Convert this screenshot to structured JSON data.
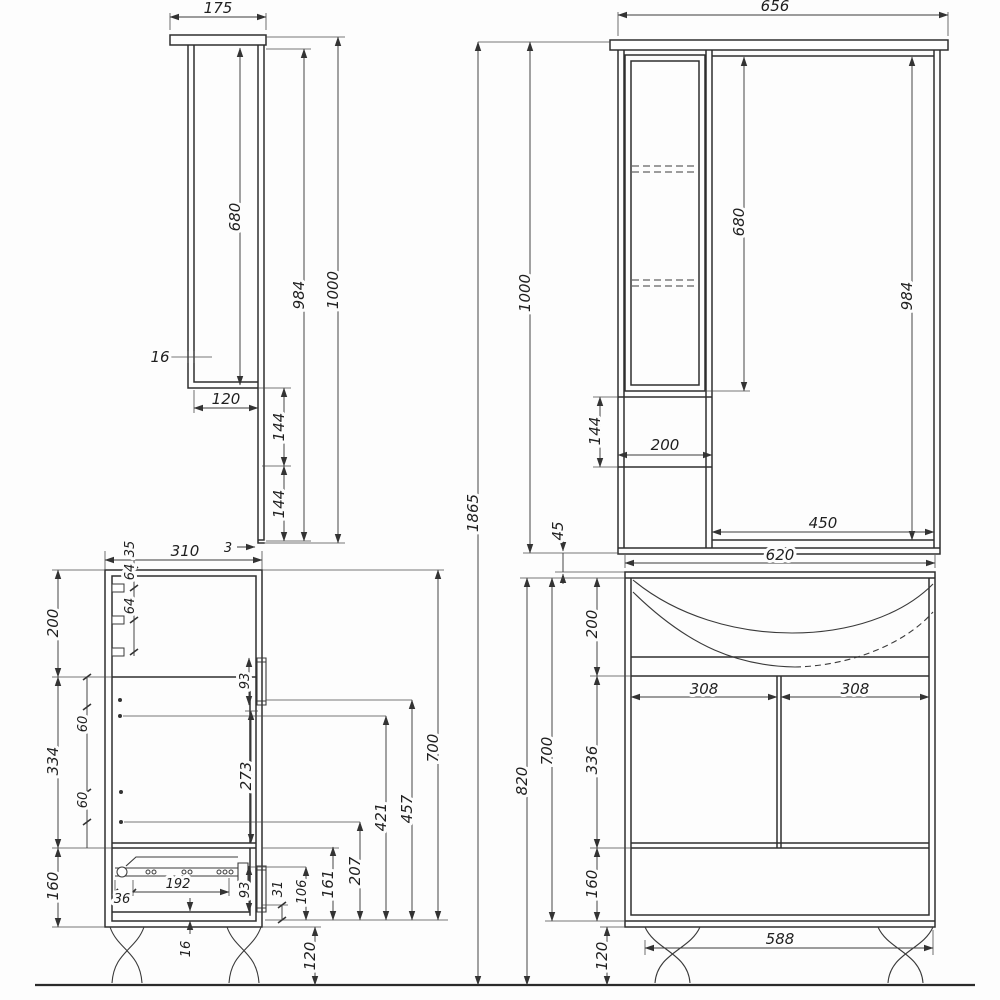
{
  "views": {
    "overall": {
      "total_height": "1865"
    },
    "mc_side": {
      "width": "175",
      "mirror_height": "680",
      "height_under_top": "984",
      "height_total": "1000",
      "panel_thickness": "16",
      "bottom_depth": "120",
      "seg_upper": "144",
      "seg_lower": "144",
      "mirror_edge": "3"
    },
    "mc_front": {
      "width": "656",
      "height_total": "1000",
      "door_height": "680",
      "mirror_height": "984",
      "lower_section": "144",
      "column_width": "200",
      "mirror_width": "450",
      "gap_to_vanity": "45"
    },
    "vanity_side": {
      "depth": "310",
      "top_offset": "35",
      "tab_gap_1": "64",
      "tab_gap_2": "64",
      "top_section": "200",
      "hinge_top": "60",
      "door_section": "334",
      "hinge_bottom": "60",
      "drawer_section": "160",
      "door_handle": "93",
      "door_inner": "273",
      "h31": "31",
      "h106": "106",
      "h161": "161",
      "h207": "207",
      "h421": "421",
      "h457": "457",
      "box_height": "700",
      "slide_offset": "36",
      "slide_length": "192",
      "drawer_handle": "93",
      "bottom_thickness": "16",
      "leg_height": "120"
    },
    "vanity_front": {
      "width": "620",
      "basin_section": "200",
      "door_left": "308",
      "door_right": "308",
      "door_height": "336",
      "box_height": "700",
      "total_height": "820",
      "drawer_height": "160",
      "leg_span": "588",
      "leg_height": "120"
    }
  }
}
